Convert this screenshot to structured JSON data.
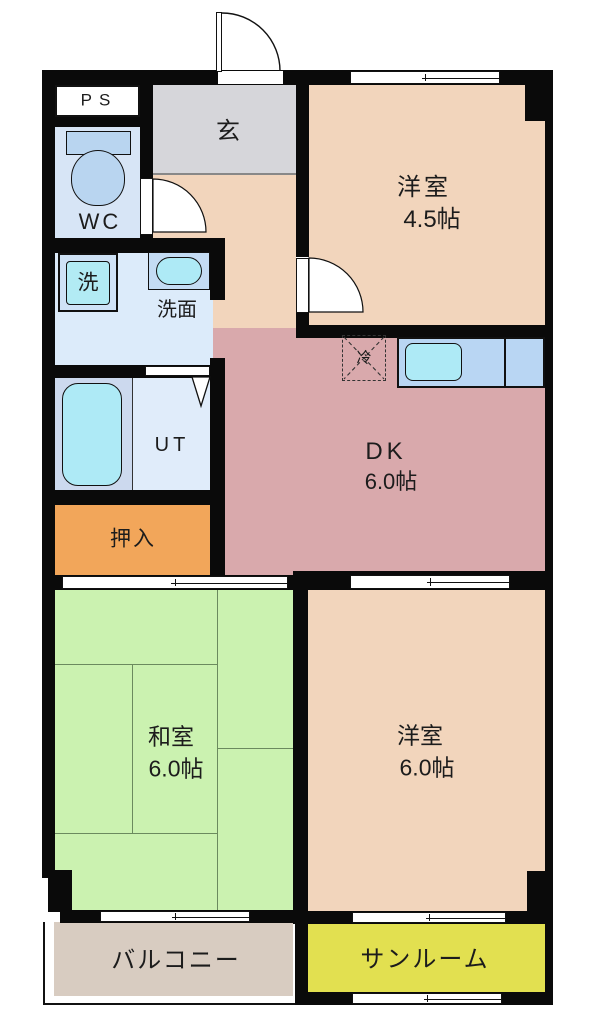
{
  "floorplan": {
    "rooms": [
      {
        "id": "ps",
        "label": "PS"
      },
      {
        "id": "genkan",
        "label": "玄"
      },
      {
        "id": "wc",
        "label": "WC"
      },
      {
        "id": "washer",
        "label": "洗"
      },
      {
        "id": "washroom",
        "label": "洗面"
      },
      {
        "id": "ut",
        "label": "UT"
      },
      {
        "id": "oshiire",
        "label": "押入"
      },
      {
        "id": "fridge",
        "label": "冷"
      },
      {
        "id": "dk",
        "label": "DK",
        "size": "6.0帖"
      },
      {
        "id": "western-4-5",
        "label": "洋室",
        "size": "4.5帖"
      },
      {
        "id": "japanese-6",
        "label": "和室",
        "size": "6.0帖"
      },
      {
        "id": "western-6",
        "label": "洋室",
        "size": "6.0帖"
      },
      {
        "id": "balcony",
        "label": "バルコニー"
      },
      {
        "id": "sunroom",
        "label": "サンルーム"
      }
    ],
    "colors": {
      "wall": "#0a0a0a",
      "room_peach": "#f2d5bc",
      "genkan_gray": "#d6d6da",
      "dk_pink": "#d9a9ac",
      "tatami_green": "#cbf2b0",
      "closet_orange": "#f2a65a",
      "balcony_tan": "#d8ccc1",
      "sunroom_yellow": "#e2e050",
      "wc_blue": "#d7e5f6",
      "washroom_blue": "#dcebfa",
      "bath_blue": "#ccd9ee",
      "ut_blue": "#e0ecfa",
      "counter_blue": "#b9d6f3",
      "fixture_blue": "#b9d5f0",
      "fixture_cyan": "#aeeaf6"
    }
  }
}
